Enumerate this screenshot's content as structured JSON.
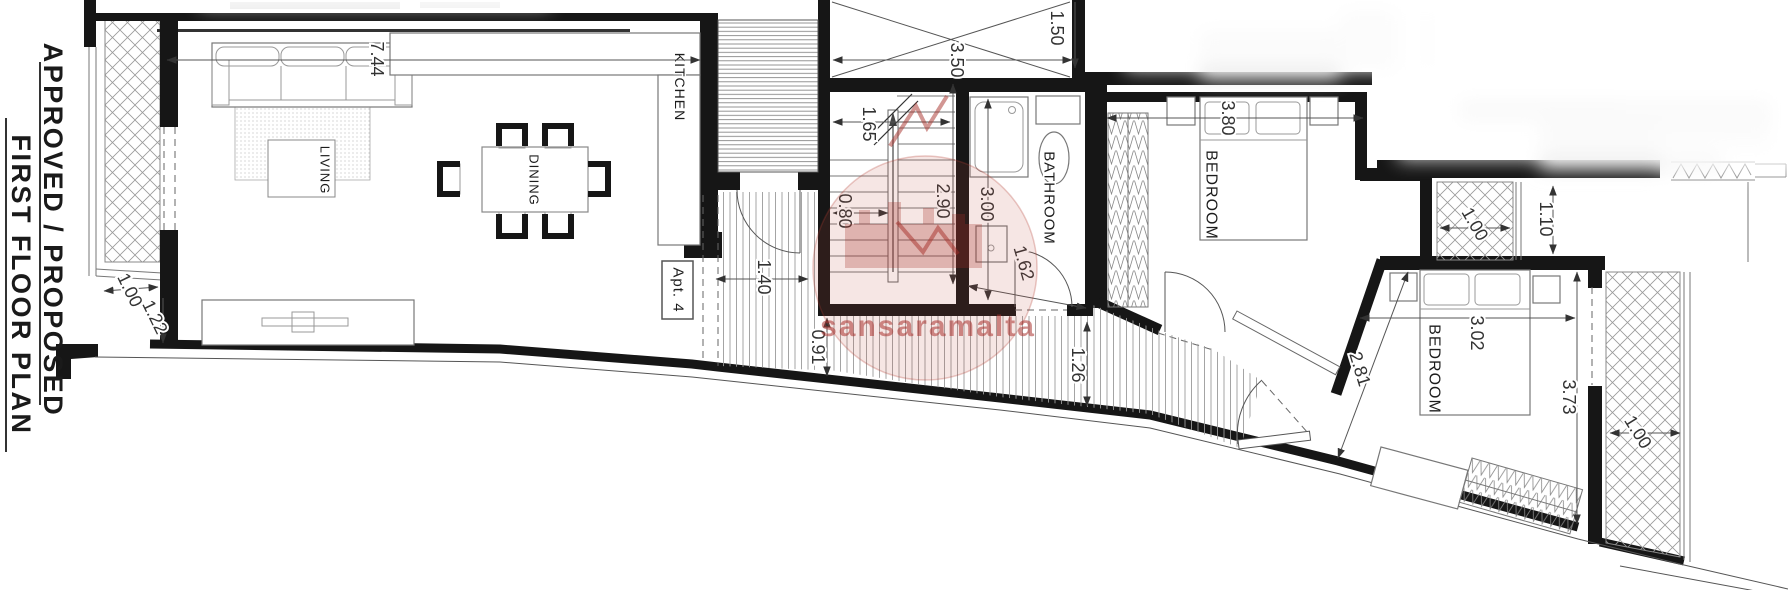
{
  "title": {
    "line1": "APPROVED / PROPOSED",
    "line2": "FIRST FLOOR PLAN"
  },
  "apartment": {
    "label": "Apt. 4"
  },
  "rooms": {
    "living": "LIVING",
    "dining": "DINING",
    "kitchen": "KITCHEN",
    "bathroom": "BATHROOM",
    "bedroom1": "BEDROOM",
    "bedroom2": "BEDROOM"
  },
  "dims": {
    "living_width": "7.44",
    "balcony_left_depth": "1.00",
    "balcony_left_drop": "1.22",
    "entrance_width": "1.40",
    "stair_landing": "1.65",
    "stair_left": "0.80",
    "stair_run": "2.90",
    "void_width": "3.50",
    "void_side": "1.50",
    "bathroom_length": "3.00",
    "bathroom_door": "1.62",
    "corridor_left": "0.91",
    "corridor_right": "1.26",
    "bedroom1_width": "3.80",
    "balcony_top_right_depth": "1.00",
    "terrace_gap": "1.10",
    "bedroom2_width": "3.02",
    "bedroom2_wall": "2.81",
    "bedroom2_length": "3.73",
    "balcony_bottom_right_depth": "1.00"
  },
  "watermark": {
    "text": "sansaramalta",
    "color": "rgba(170,50,45,0.55)"
  },
  "colors": {
    "wall": "#161616",
    "hatch": "#999999",
    "dim": "#333333",
    "watermark": "#a63d35"
  }
}
